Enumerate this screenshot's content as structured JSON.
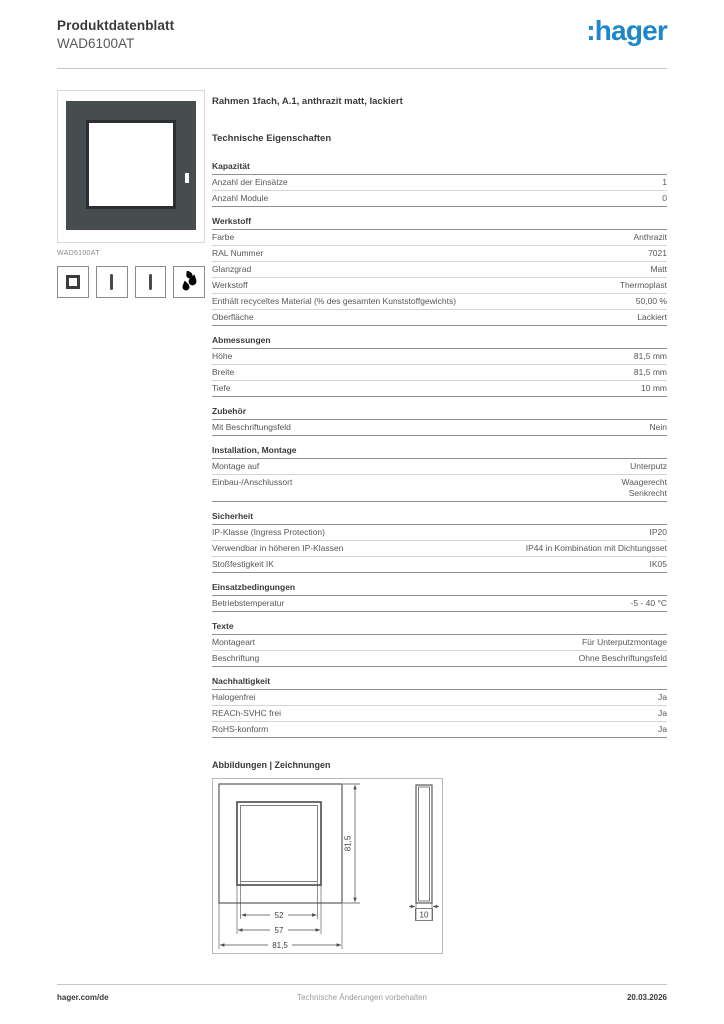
{
  "header": {
    "doc_type": "Produktdatenblatt",
    "product_code": "WAD6100AT",
    "logo_text": ":hager"
  },
  "brand": {
    "blue": "#1e87c8"
  },
  "product": {
    "image_caption": "WAD6100AT",
    "title": "Rahmen 1fach, A.1, anthrazit matt, lackiert",
    "icons": [
      "frame-icon",
      "vertical-module-icon",
      "vertical-module-icon",
      "paint-drops-icon"
    ],
    "frame_color": "#474c4f"
  },
  "tech": {
    "heading": "Technische Eigenschaften",
    "sections": [
      {
        "title": "Kapazität",
        "rows": [
          {
            "label": "Anzahl der Einsätze",
            "value": "1"
          },
          {
            "label": "Anzahl Module",
            "value": "0"
          }
        ]
      },
      {
        "title": "Werkstoff",
        "rows": [
          {
            "label": "Farbe",
            "value": "Anthrazit"
          },
          {
            "label": "RAL Nummer",
            "value": "7021"
          },
          {
            "label": "Glanzgrad",
            "value": "Matt"
          },
          {
            "label": "Werkstoff",
            "value": "Thermoplast"
          },
          {
            "label": "Enthält recyceltes Material (% des gesamten Kunststoffgewichts)",
            "value": "50,00 %"
          },
          {
            "label": "Oberfläche",
            "value": "Lackiert"
          }
        ]
      },
      {
        "title": "Abmessungen",
        "rows": [
          {
            "label": "Höhe",
            "value": "81,5 mm"
          },
          {
            "label": "Breite",
            "value": "81,5 mm"
          },
          {
            "label": "Tiefe",
            "value": "10 mm"
          }
        ]
      },
      {
        "title": "Zubehör",
        "rows": [
          {
            "label": "Mit Beschriftungsfeld",
            "value": "Nein"
          }
        ]
      },
      {
        "title": "Installation, Montage",
        "rows": [
          {
            "label": "Montage auf",
            "value": "Unterputz"
          },
          {
            "label": "Einbau-/Anschlussort",
            "value": "Waagerecht\nSenkrecht"
          }
        ]
      },
      {
        "title": "Sicherheit",
        "rows": [
          {
            "label": "IP-Klasse (Ingress Protection)",
            "value": "IP20"
          },
          {
            "label": "Verwendbar in höheren IP-Klassen",
            "value": "IP44 in Kombination mit Dichtungsset"
          },
          {
            "label": "Stoßfestigkeit IK",
            "value": "IK05"
          }
        ]
      },
      {
        "title": "Einsatzbedingungen",
        "rows": [
          {
            "label": "Betriebstemperatur",
            "value": "-5 - 40 °C"
          }
        ]
      },
      {
        "title": "Texte",
        "rows": [
          {
            "label": "Montageart",
            "value": "Für Unterputzmontage"
          },
          {
            "label": "Beschriftung",
            "value": "Ohne Beschriftungsfeld"
          }
        ]
      },
      {
        "title": "Nachhaltigkeit",
        "rows": [
          {
            "label": "Halogenfrei",
            "value": "Ja"
          },
          {
            "label": "REACh-SVHC frei",
            "value": "Ja"
          },
          {
            "label": "RoHS-konform",
            "value": "Ja"
          }
        ]
      }
    ]
  },
  "drawings": {
    "heading": "Abbildungen | Zeichnungen",
    "dims": {
      "front_height": "81,5",
      "inner_width": "52",
      "mid_width": "57",
      "outer_width": "81,5",
      "depth": "10"
    }
  },
  "footer": {
    "left": "hager.com/de",
    "center": "Technische Änderungen vorbehalten",
    "right": "20.03.2026"
  }
}
